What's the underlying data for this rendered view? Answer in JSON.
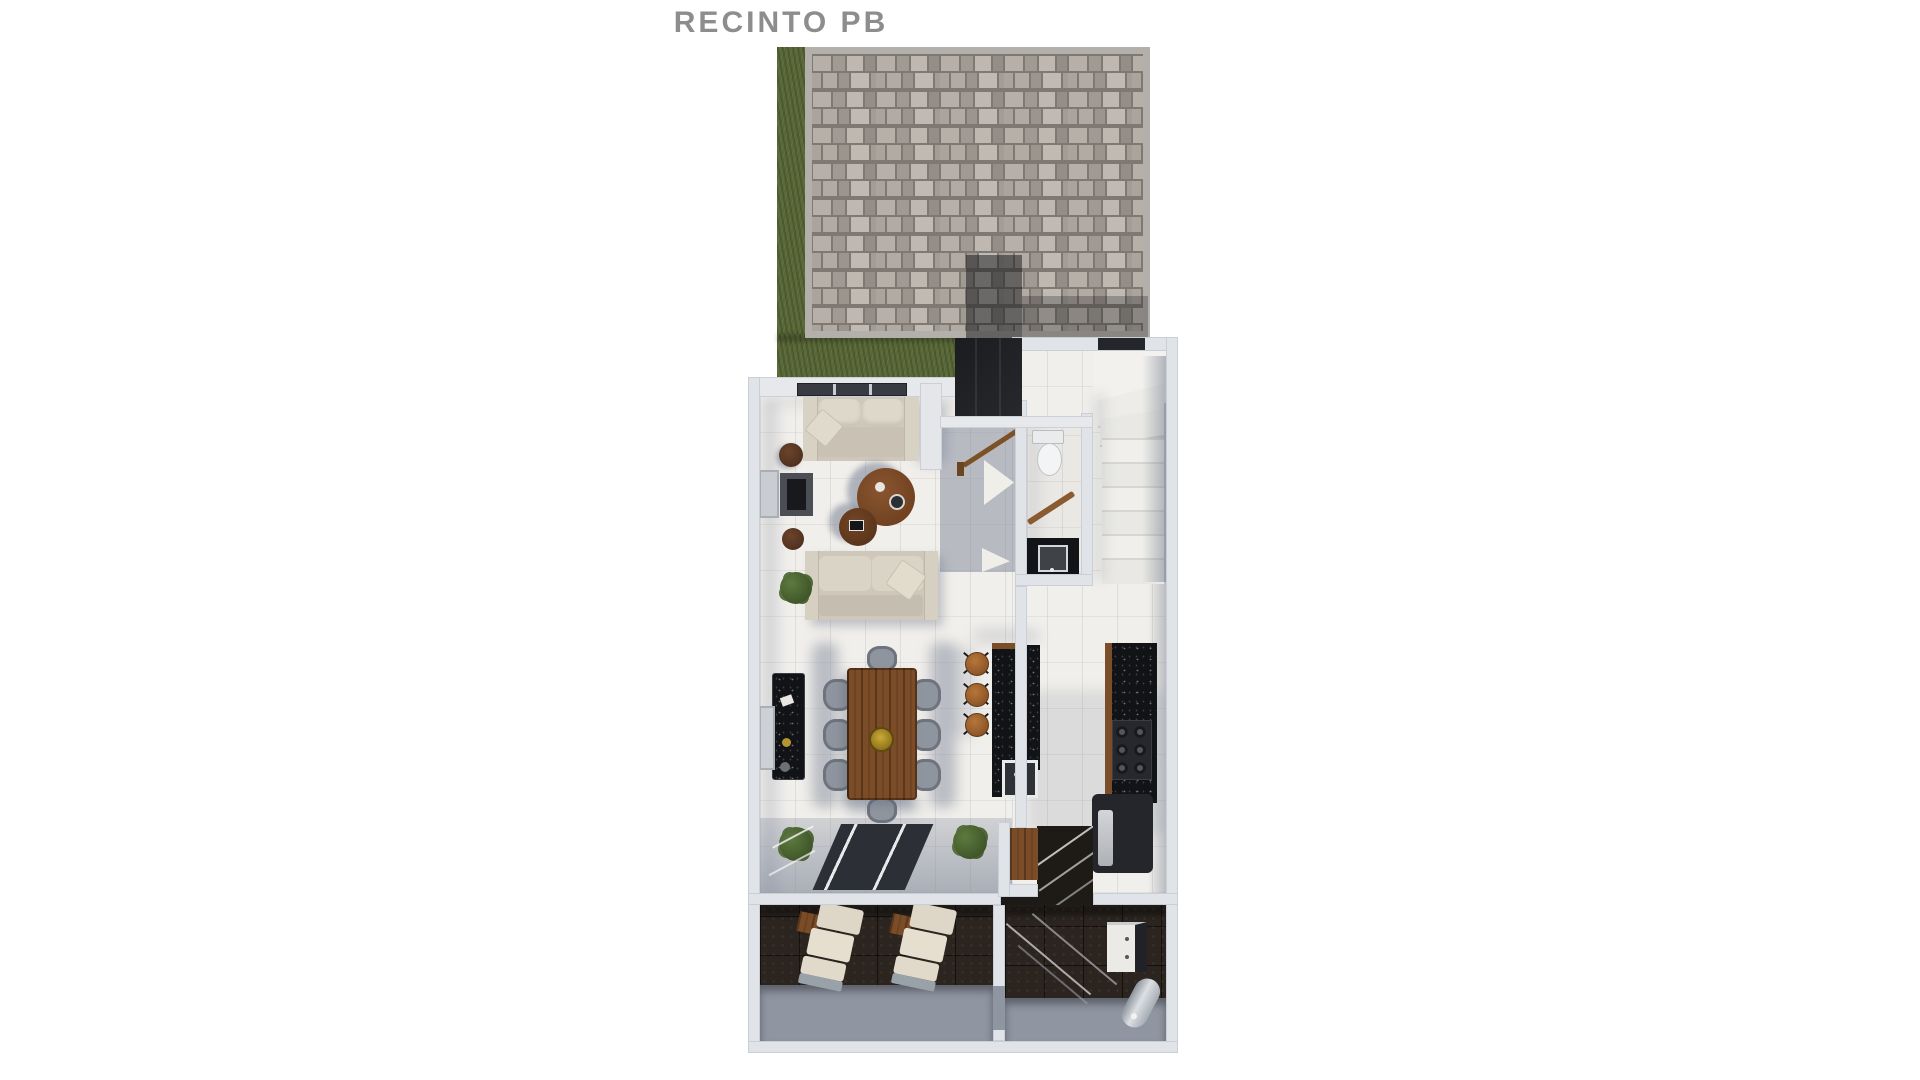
{
  "title": "RECINTO PB",
  "colors": {
    "background": "#ffffff",
    "title_text": "#8d8d8d",
    "walls": "#e0e3e7",
    "marble_floor": "#f1efeb",
    "floor_shadow": "#778195",
    "grass": "#5a6838",
    "pavers": "#a8a29c",
    "paver_joint": "#7e7973",
    "dark_glass": "#1b1d21",
    "sofa_cream": "#cfc8ba",
    "wood_furniture": "#7a4c28",
    "gold_centerpiece": "#b6972f",
    "dining_chair_gray": "#8f959e",
    "counter_black": "#121316",
    "stool_wood": "#a96f36",
    "terrace_dark_tile": "#2b241f",
    "terrace_concrete": "#8f96a2",
    "lounge_cushion": "#ded6c7"
  }
}
